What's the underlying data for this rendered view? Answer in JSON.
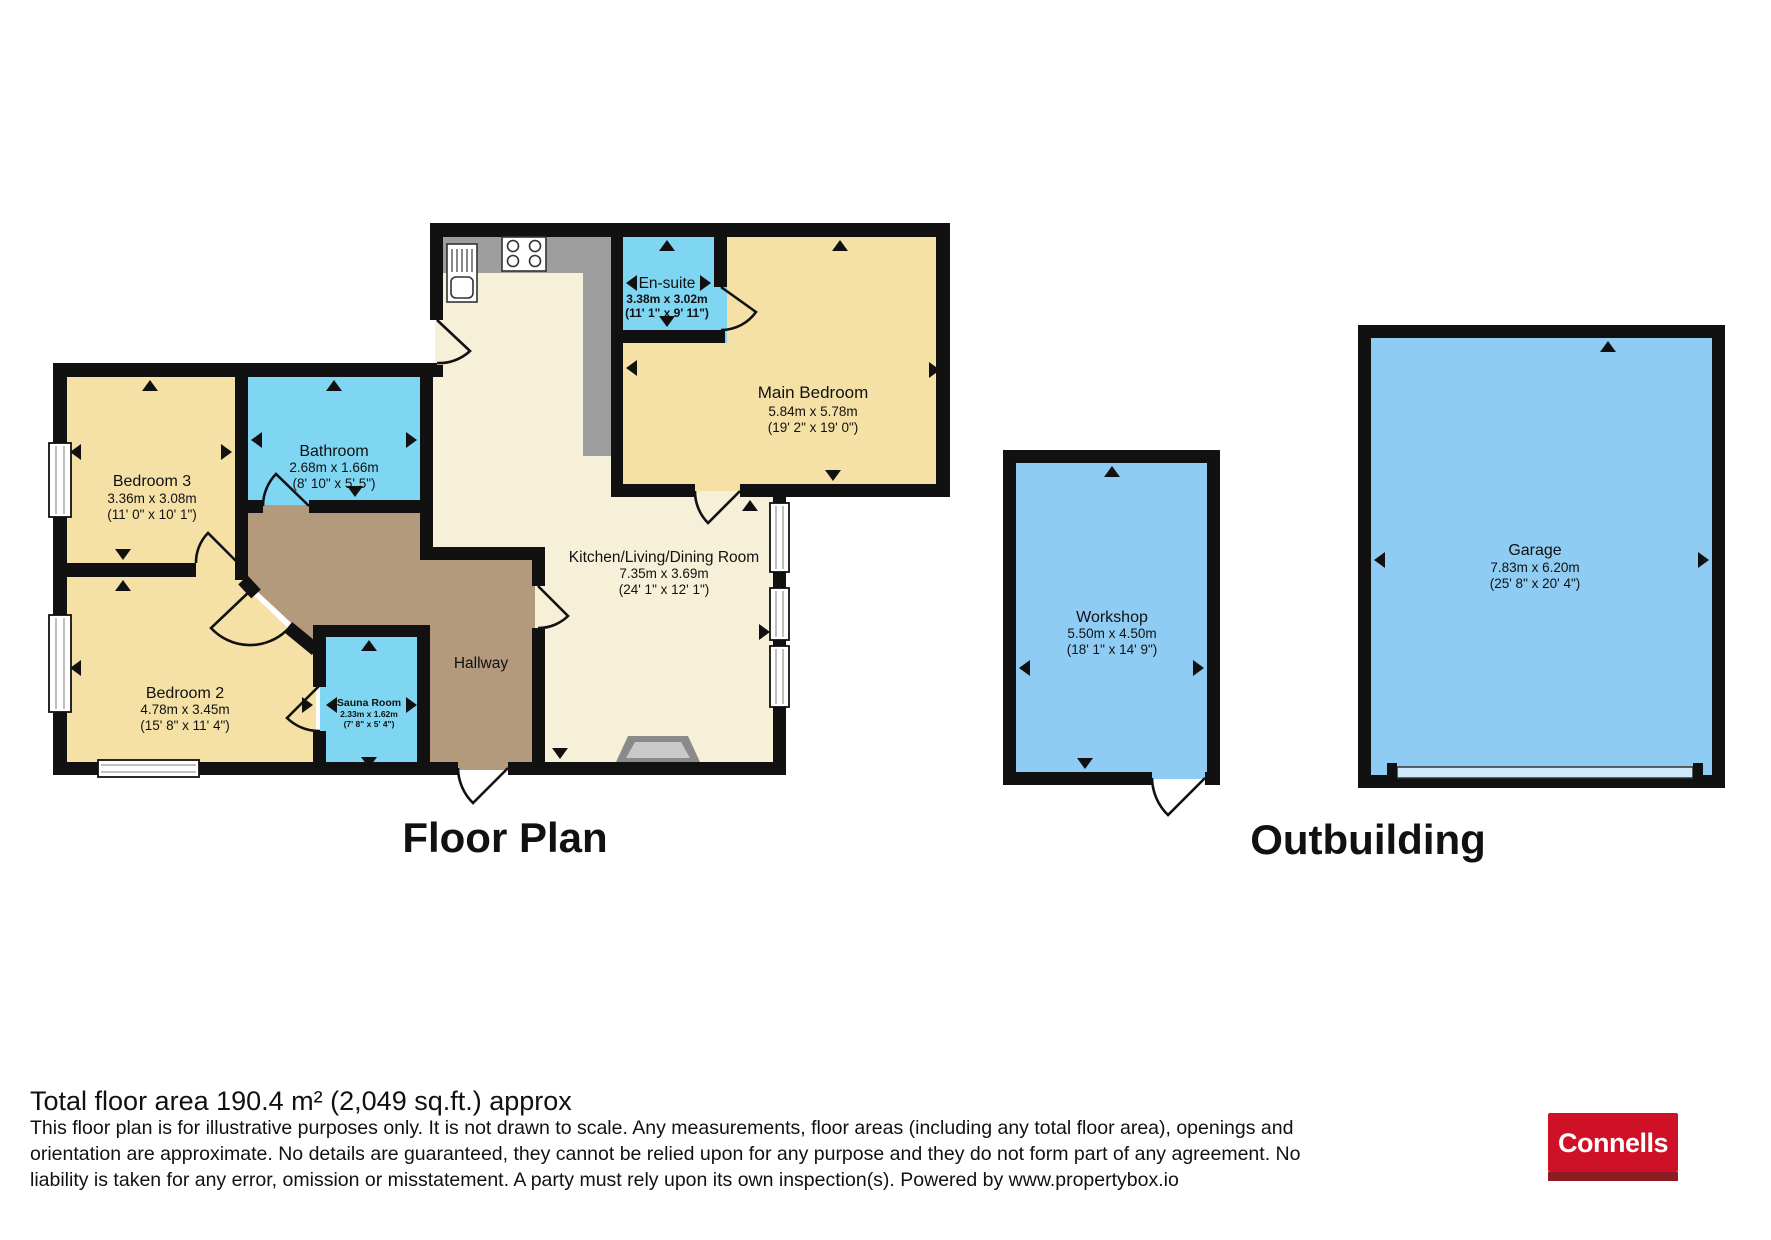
{
  "titles": {
    "floor_plan": "Floor Plan",
    "outbuilding": "Outbuilding"
  },
  "rooms": {
    "bedroom3": {
      "name": "Bedroom 3",
      "metric": "3.36m x 3.08m",
      "imperial": "(11' 0\" x 10' 1\")"
    },
    "bathroom": {
      "name": "Bathroom",
      "metric": "2.68m x 1.66m",
      "imperial": "(8' 10\" x 5' 5\")"
    },
    "bedroom2": {
      "name": "Bedroom 2",
      "metric": "4.78m x 3.45m",
      "imperial": "(15' 8\" x 11' 4\")"
    },
    "sauna": {
      "name": "Sauna Room",
      "metric": "2.33m x 1.62m",
      "imperial": "(7' 8\" x 5' 4\")"
    },
    "hallway": {
      "name": "Hallway"
    },
    "kitchen_living_dining": {
      "name": "Kitchen/Living/Dining Room",
      "metric": "7.35m x 3.69m",
      "imperial": "(24' 1\" x 12' 1\")"
    },
    "ensuite": {
      "name": "En-suite",
      "metric": "3.38m x 3.02m",
      "imperial": "(11' 1\" x 9' 11\")"
    },
    "main_bedroom": {
      "name": "Main Bedroom",
      "metric": "5.84m x 5.78m",
      "imperial": "(19' 2\" x 19' 0\")"
    },
    "workshop": {
      "name": "Workshop",
      "metric": "5.50m x 4.50m",
      "imperial": "(18' 1\" x 14' 9\")"
    },
    "garage": {
      "name": "Garage",
      "metric": "7.83m x 6.20m",
      "imperial": "(25' 8\" x 20' 4\")"
    }
  },
  "footer": {
    "total_area": "Total floor area 190.4 m² (2,049 sq.ft.) approx",
    "disclaimer_line1": "This floor plan is for illustrative purposes only. It is not drawn to scale. Any measurements, floor areas (including any total floor area), openings and",
    "disclaimer_line2": "orientation are approximate. No details are guaranteed, they cannot be relied upon for any purpose and they do not form part of any agreement. No",
    "disclaimer_line3": "liability is taken for any error, omission or misstatement. A party must rely upon its own inspection(s). Powered by www.propertybox.io"
  },
  "logo": {
    "text": "Connells"
  },
  "colors": {
    "wall": "#111111",
    "bedroom_fill": "#f5e1a6",
    "living_fill": "#f7f0d8",
    "wet_room_fill": "#7fd6f2",
    "hallway_fill": "#b39a7c",
    "outbuilding_fill": "#8fccf3",
    "counter_grey": "#9e9e9e",
    "logo_red": "#ce1126",
    "logo_dark_red": "#8e1b21"
  }
}
